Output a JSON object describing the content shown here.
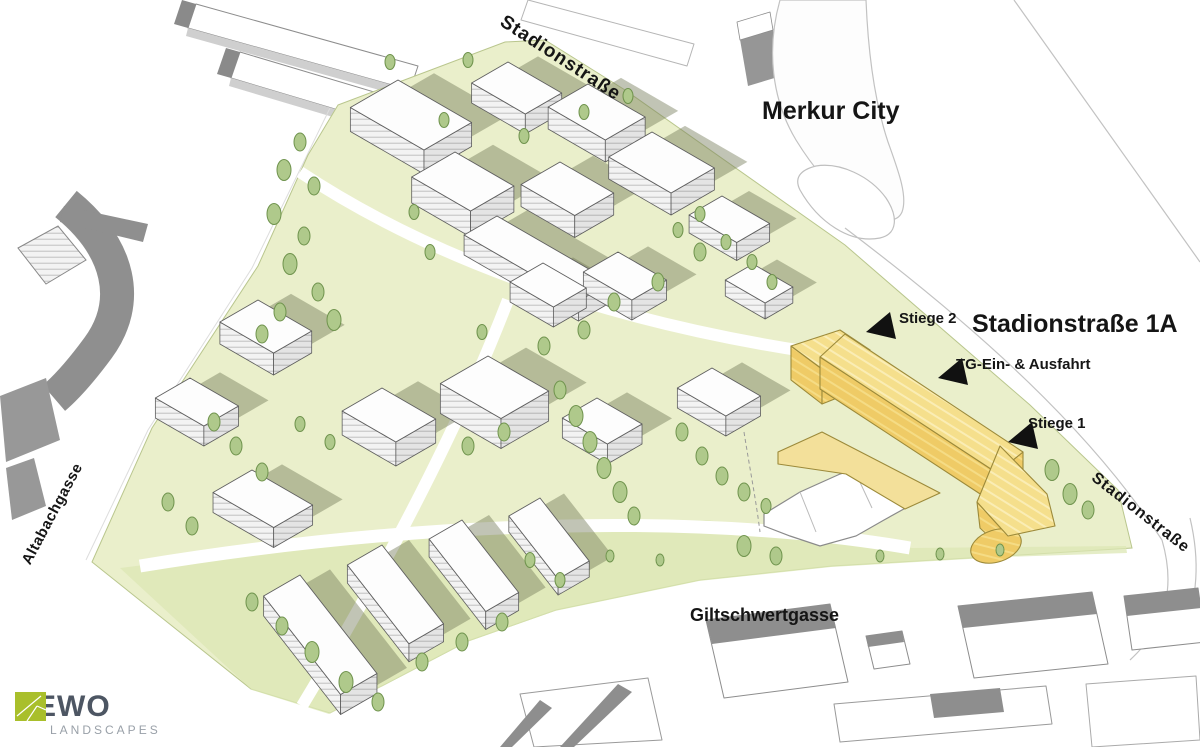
{
  "streets": {
    "stadionstrasse_top": "Stadionstraße",
    "stadionstrasse_right": "Stadionstraße",
    "altabachgasse": "Altabachgasse",
    "giltschwertgasse": "Giltschwertgasse"
  },
  "areas": {
    "merkur_city": "Merkur City"
  },
  "project": {
    "title": "Stadionstraße 1A",
    "stiege2": "Stiege 2",
    "tg": "TG-Ein- & Ausfahrt",
    "stiege1": "Stiege 1"
  },
  "colors": {
    "highlight_wall": "#EFCB66",
    "highlight_roof": "#F5DF8C",
    "site_green": "#EAEFCB",
    "site_green_dark": "#DCE7B4",
    "tree_green": "#AFC98B",
    "context_gray": "#8F8F8F",
    "marker_black": "#111111",
    "logo_green": "#A9BF2B",
    "logo_text": "#4D5663"
  },
  "logo": {
    "brand": "YEWO",
    "subtitle": "LANDSCAPES"
  }
}
